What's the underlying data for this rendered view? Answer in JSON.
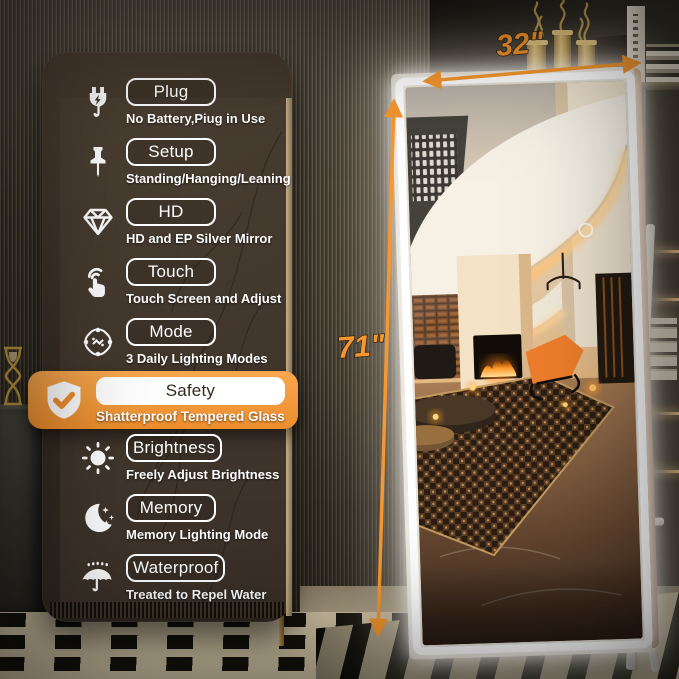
{
  "features": [
    {
      "label": "Plug",
      "desc": "No Battery,Piug in Use",
      "icon": "plug-icon"
    },
    {
      "label": "Setup",
      "desc": "Standing/Hanging/Leaning",
      "icon": "pushpin-icon"
    },
    {
      "label": "HD",
      "desc": "HD and EP Silver Mirror",
      "icon": "diamond-icon"
    },
    {
      "label": "Touch",
      "desc": "Touch Screen and Adjust",
      "icon": "touch-icon"
    },
    {
      "label": "Mode",
      "desc": "3 Daily Lighting Modes",
      "icon": "mode-icon"
    },
    {
      "label": "Safety",
      "desc": "Shatterproof Tempered Glass",
      "icon": "shield-check-icon",
      "highlighted": true
    },
    {
      "label": "Brightness",
      "desc": "Freely Adjust Brightness",
      "icon": "sun-icon"
    },
    {
      "label": "Memory",
      "desc": "Memory Lighting Mode",
      "icon": "moon-stars-icon"
    },
    {
      "label": "Waterproof",
      "desc": "Treated to Repel Water",
      "icon": "umbrella-icon"
    }
  ],
  "dimensions": {
    "width_label": "32\"",
    "height_label": "71\""
  },
  "palette": {
    "accent_orange": "#F6982F",
    "banner_orange": "#EE8E2C",
    "led_white": "#FFFFFF",
    "panel_brown": "#3A3127",
    "wall_brown": "#45403A"
  }
}
